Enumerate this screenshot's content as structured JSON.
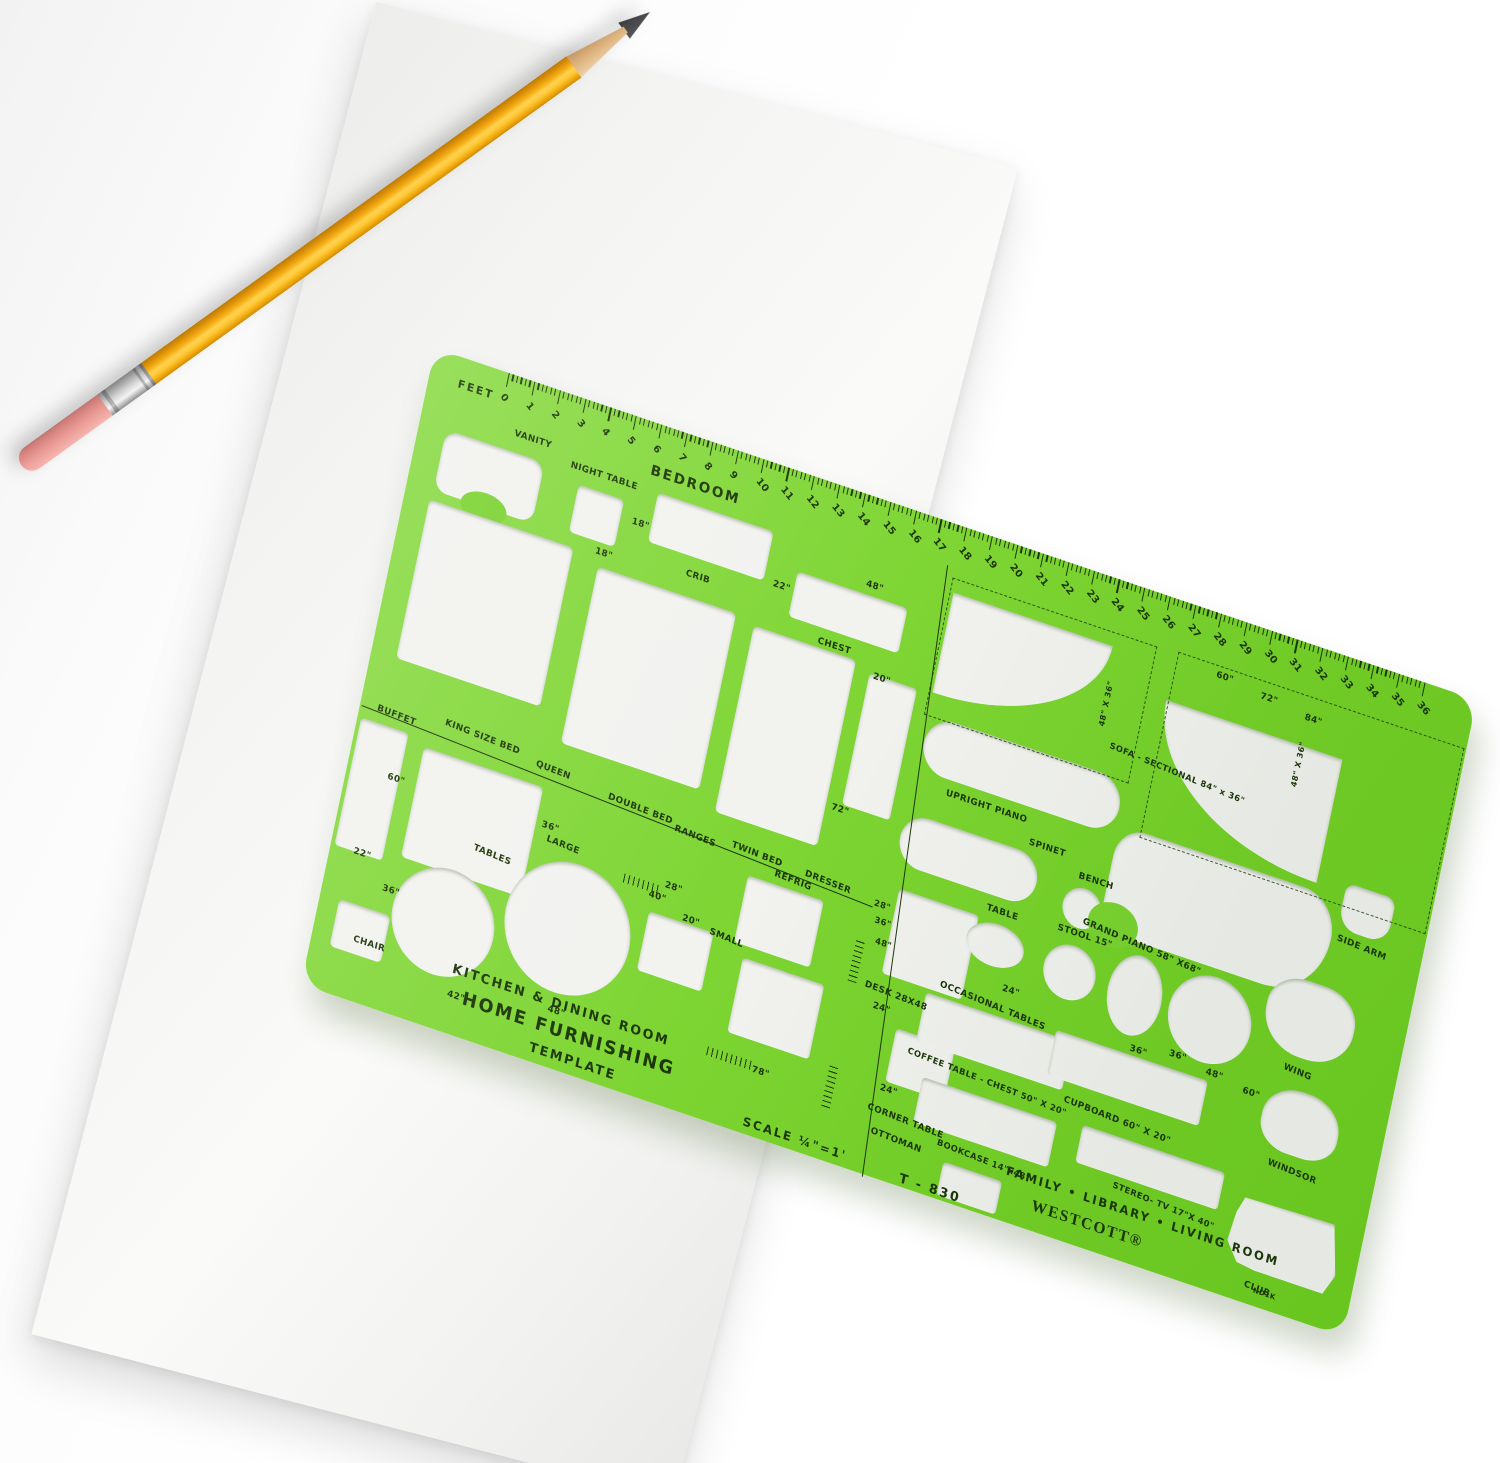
{
  "scene": {
    "background_color": "#ffffff",
    "paper": {
      "color": "#f4f4f2"
    },
    "pencil": {
      "body": "#f3a90e",
      "eraser": "#e8948f",
      "ferrule": "#cfcfcf",
      "wood": "#dfb684",
      "lead": "#454545"
    },
    "template": {
      "color": "#7bd331",
      "text_color": "#1c3608",
      "model": "T - 830",
      "scale": "SCALE ¼\"=1'",
      "brand": "WESTCOTT®",
      "part_code": "ND1K",
      "ruler": {
        "label": "FEET",
        "start": 0,
        "end": 36
      },
      "headings": {
        "bedroom": "BEDROOM",
        "kitchen": "KITCHEN & DINING ROOM",
        "product1": "HOME FURNISHING",
        "product2": "TEMPLATE",
        "family": "FAMILY • LIBRARY • LIVING ROOM"
      },
      "labels": [
        {
          "n": "bedroom-heading",
          "t": "BEDROOM",
          "x": 238,
          "y": 40,
          "fs": 14,
          "cls": "hd"
        },
        {
          "n": "vanity",
          "t": "VANITY",
          "x": 96,
          "y": 52,
          "fs": 9
        },
        {
          "n": "night-table",
          "t": "NIGHT TABLE",
          "x": 158,
          "y": 64,
          "fs": 9
        },
        {
          "n": "dim-18a",
          "t": "18\"",
          "x": 230,
          "y": 98,
          "fs": 9
        },
        {
          "n": "dim-18b",
          "t": "18\"",
          "x": 200,
          "y": 138,
          "fs": 9
        },
        {
          "n": "crib",
          "t": "CRIB",
          "x": 294,
          "y": 130,
          "fs": 9
        },
        {
          "n": "dim-22crib",
          "t": "22\"",
          "x": 382,
          "y": 112,
          "fs": 9
        },
        {
          "n": "dim-48chest",
          "t": "48\"",
          "x": 474,
          "y": 82,
          "fs": 9
        },
        {
          "n": "chest",
          "t": "CHEST",
          "x": 438,
          "y": 152,
          "fs": 9
        },
        {
          "n": "dim-20chest",
          "t": "20\"",
          "x": 500,
          "y": 168,
          "fs": 9
        },
        {
          "n": "dim-72",
          "t": "72\"",
          "x": 486,
          "y": 306,
          "fs": 9
        },
        {
          "n": "buffet",
          "t": "BUFFET",
          "x": 18,
          "y": 358,
          "fs": 9,
          "rot": 3
        },
        {
          "n": "king-size-bed",
          "t": "KING SIZE BED",
          "x": 88,
          "y": 350,
          "fs": 9,
          "rot": 3
        },
        {
          "n": "queen",
          "t": "QUEEN",
          "x": 186,
          "y": 360,
          "fs": 9,
          "rot": 3
        },
        {
          "n": "double-bed",
          "t": "DOUBLE BED",
          "x": 264,
          "y": 368,
          "fs": 9,
          "rot": 3
        },
        {
          "n": "ranges",
          "t": "RANGES",
          "x": 336,
          "y": 377,
          "fs": 9,
          "rot": 3
        },
        {
          "n": "twin-bed",
          "t": "TWIN BED",
          "x": 396,
          "y": 374,
          "fs": 9,
          "rot": 3
        },
        {
          "n": "refrig",
          "t": "REFRIG",
          "x": 444,
          "y": 388,
          "fs": 9,
          "rot": 3
        },
        {
          "n": "dresser",
          "t": "DRESSER",
          "x": 474,
          "y": 378,
          "fs": 9,
          "rot": 3
        },
        {
          "n": "dim-60queen",
          "t": "60\"",
          "x": 42,
          "y": 420,
          "fs": 9
        },
        {
          "n": "dim-36queen",
          "t": "36\"",
          "x": 204,
          "y": 416,
          "fs": 9
        },
        {
          "n": "dim-36tables",
          "t": "36\"",
          "x": 60,
          "y": 528,
          "fs": 9
        },
        {
          "n": "dim-22chair",
          "t": "22\"",
          "x": 24,
          "y": 502,
          "fs": 9
        },
        {
          "n": "chair",
          "t": "CHAIR",
          "x": 42,
          "y": 586,
          "fs": 9
        },
        {
          "n": "tables",
          "t": "TABLES",
          "x": 142,
          "y": 460,
          "fs": 9,
          "rot": 4
        },
        {
          "n": "large",
          "t": "LARGE",
          "x": 212,
          "y": 428,
          "fs": 9,
          "rot": 4
        },
        {
          "n": "dim-42",
          "t": "42\"",
          "x": 146,
          "y": 608,
          "fs": 9
        },
        {
          "n": "dim-48tables",
          "t": "48\"",
          "x": 248,
          "y": 590,
          "fs": 9
        },
        {
          "n": "dim-28range",
          "t": "28\"",
          "x": 338,
          "y": 434,
          "fs": 9
        },
        {
          "n": "dim-40",
          "t": "40\"",
          "x": 324,
          "y": 448,
          "fs": 9
        },
        {
          "n": "dim-20small",
          "t": "20\"",
          "x": 362,
          "y": 460,
          "fs": 9
        },
        {
          "n": "small",
          "t": "SMALL",
          "x": 392,
          "y": 464,
          "fs": 9,
          "rot": 4
        },
        {
          "n": "dim-78",
          "t": "78\"",
          "x": 462,
          "y": 582,
          "fs": 9
        },
        {
          "n": "dim-28div",
          "t": "28\"",
          "x": 548,
          "y": 384,
          "fs": 8.5
        },
        {
          "n": "dim-36div",
          "t": "36\"",
          "x": 552,
          "y": 400,
          "fs": 8.5
        },
        {
          "n": "dim-48div",
          "t": "48\"",
          "x": 557,
          "y": 420,
          "fs": 8.5
        },
        {
          "n": "kitchen-heading",
          "t": "KITCHEN & DINING ROOM",
          "x": 146,
          "y": 580,
          "fs": 13,
          "cls": "hd"
        },
        {
          "n": "home-furnishing",
          "t": "HOME FURNISHING",
          "x": 162,
          "y": 603,
          "fs": 18,
          "cls": "hd"
        },
        {
          "n": "template-word",
          "t": "TEMPLATE",
          "x": 238,
          "y": 630,
          "fs": 13,
          "cls": "hd"
        },
        {
          "n": "scale",
          "t": "SCALE ¼\"=1'",
          "x": 464,
          "y": 632,
          "fs": 12,
          "cls": "hd"
        },
        {
          "n": "model",
          "t": "T - 830",
          "x": 630,
          "y": 636,
          "fs": 13,
          "cls": "hd"
        },
        {
          "n": "family-heading",
          "t": "FAMILY • LIBRARY • LIVING ROOM",
          "x": 734,
          "y": 594,
          "fs": 12,
          "cls": "hd"
        },
        {
          "n": "brand",
          "t": "WESTCOTT®",
          "x": 766,
          "y": 618,
          "fs": 16,
          "cls": "brand"
        },
        {
          "n": "part-code",
          "t": "ND1K",
          "x": 1002,
          "y": 632,
          "fs": 7
        },
        {
          "n": "upright-piano",
          "t": "UPRIGHT PIANO",
          "x": 596,
          "y": 256,
          "fs": 9
        },
        {
          "n": "sofa-sectional",
          "t": "SOFA - SECTIONAL 84\" x 36\"",
          "x": 748,
          "y": 158,
          "fs": 8.5,
          "rot": 4
        },
        {
          "n": "dim-48x36-a",
          "t": "48\" X 36\"",
          "x": 732,
          "y": 100,
          "fs": 8,
          "vert": 1
        },
        {
          "n": "dim-48x36-b",
          "t": "48\" X 36\"",
          "x": 934,
          "y": 96,
          "fs": 8,
          "vert": 1
        },
        {
          "n": "dim-60sofa",
          "t": "60\"",
          "x": 838,
          "y": 56,
          "fs": 9
        },
        {
          "n": "dim-72sofa",
          "t": "72\"",
          "x": 886,
          "y": 62,
          "fs": 9
        },
        {
          "n": "dim-84sofa",
          "t": "84\"",
          "x": 934,
          "y": 68,
          "fs": 9
        },
        {
          "n": "spinet",
          "t": "SPINET",
          "x": 688,
          "y": 276,
          "fs": 9
        },
        {
          "n": "bench",
          "t": "BENCH",
          "x": 744,
          "y": 292,
          "fs": 9
        },
        {
          "n": "table",
          "t": "TABLE",
          "x": 660,
          "y": 352,
          "fs": 9
        },
        {
          "n": "stool",
          "t": "STOOL 15\"",
          "x": 734,
          "y": 348,
          "fs": 9
        },
        {
          "n": "dim-24occ",
          "t": "24\"",
          "x": 692,
          "y": 424,
          "fs": 9
        },
        {
          "n": "occasional-tables",
          "t": "OCCASIONAL TABLES",
          "x": 630,
          "y": 440,
          "fs": 9,
          "rot": 4
        },
        {
          "n": "grand-piano",
          "t": "GRAND PIANO 58\" X68\"",
          "x": 758,
          "y": 334,
          "fs": 9,
          "rot": 5
        },
        {
          "n": "dim-36grand",
          "t": "36\"",
          "x": 830,
          "y": 440,
          "fs": 9
        },
        {
          "n": "side-arm",
          "t": "SIDE ARM",
          "x": 1012,
          "y": 268,
          "fs": 9,
          "rot": 4
        },
        {
          "n": "wing",
          "t": "WING",
          "x": 986,
          "y": 408,
          "fs": 9,
          "rot": 4
        },
        {
          "n": "windsor",
          "t": "WINDSOR",
          "x": 990,
          "y": 504,
          "fs": 9,
          "rot": 4
        },
        {
          "n": "club",
          "t": "CLUB",
          "x": 992,
          "y": 628,
          "fs": 9,
          "rot": 4
        },
        {
          "n": "dim-36cup",
          "t": "36\"",
          "x": 870,
          "y": 432,
          "fs": 9
        },
        {
          "n": "dim-48cup",
          "t": "48\"",
          "x": 910,
          "y": 438,
          "fs": 9
        },
        {
          "n": "dim-60cup",
          "t": "60\"",
          "x": 950,
          "y": 444,
          "fs": 9
        },
        {
          "n": "cupboard",
          "t": "CUPBOARD  60\"  X 20\"",
          "x": 776,
          "y": 510,
          "fs": 9,
          "rot": 3
        },
        {
          "n": "stereo-tv",
          "t": "STEREO- TV  17\"X 40\"",
          "x": 842,
          "y": 576,
          "fs": 8.5,
          "rot": 4
        },
        {
          "n": "coffee-table",
          "t": "COFFEE TABLE - CHEST  50\"  X 20\"",
          "x": 612,
          "y": 514,
          "fs": 8.5,
          "rot": 3
        },
        {
          "n": "bookcase",
          "t": "BOOKCASE 14\"x48\"",
          "x": 660,
          "y": 592,
          "fs": 8.5,
          "rot": 3
        },
        {
          "n": "desk",
          "t": "DESK  28X48",
          "x": 556,
          "y": 464,
          "fs": 9,
          "rot": 3
        },
        {
          "n": "dim-24desk",
          "t": "24\"",
          "x": 568,
          "y": 482,
          "fs": 9
        },
        {
          "n": "dim-24corner",
          "t": "24\"",
          "x": 592,
          "y": 558,
          "fs": 9
        },
        {
          "n": "corner-table",
          "t": "CORNER TABLE",
          "x": 584,
          "y": 580,
          "fs": 9,
          "rot": 3
        },
        {
          "n": "ottoman",
          "t": "OTTOMAN",
          "x": 592,
          "y": 602,
          "fs": 9,
          "rot": 3
        }
      ],
      "cutouts": [
        {
          "n": "vanity",
          "x": 28,
          "y": 74,
          "w": 104,
          "h": 62,
          "br": "14px",
          "cls": "notch-b"
        },
        {
          "n": "night-table",
          "x": 170,
          "y": 84,
          "w": 48,
          "h": 48,
          "br": "5px"
        },
        {
          "n": "crib",
          "x": 250,
          "y": 66,
          "w": 122,
          "h": 50,
          "br": "5px"
        },
        {
          "n": "chest",
          "x": 404,
          "y": 96,
          "w": 116,
          "h": 46,
          "br": "5px"
        },
        {
          "n": "king-bed",
          "x": 26,
          "y": 146,
          "w": 152,
          "h": 162,
          "br": "5px"
        },
        {
          "n": "double-bed",
          "x": 206,
          "y": 156,
          "w": 146,
          "h": 180,
          "br": "5px"
        },
        {
          "n": "twin-bed",
          "x": 372,
          "y": 162,
          "w": 108,
          "h": 190,
          "br": "5px"
        },
        {
          "n": "dresser-tall",
          "x": 496,
          "y": 170,
          "w": 50,
          "h": 134,
          "br": "4px"
        },
        {
          "n": "buffet",
          "x": 4,
          "y": 376,
          "w": 50,
          "h": 130,
          "br": "4px"
        },
        {
          "n": "queen-bed",
          "x": 72,
          "y": 384,
          "w": 126,
          "h": 112,
          "br": "5px"
        },
        {
          "n": "chair",
          "x": 20,
          "y": 556,
          "w": 54,
          "h": 48,
          "br": "5px"
        },
        {
          "n": "table-42",
          "x": 74,
          "y": 492,
          "w": 106,
          "h": 106,
          "br": "50%"
        },
        {
          "n": "table-48",
          "x": 186,
          "y": 446,
          "w": 130,
          "h": 130,
          "br": "50%"
        },
        {
          "n": "range-small",
          "x": 328,
          "y": 468,
          "w": 68,
          "h": 60,
          "br": "4px"
        },
        {
          "n": "refrigerator",
          "x": 418,
          "y": 402,
          "w": 80,
          "h": 68,
          "br": "4px"
        },
        {
          "n": "dresser-low",
          "x": 430,
          "y": 482,
          "w": 86,
          "h": 76,
          "br": "4px"
        },
        {
          "n": "desk",
          "x": 570,
          "y": 366,
          "w": 84,
          "h": 86,
          "br": "4px"
        },
        {
          "n": "corner-table",
          "x": 596,
          "y": 500,
          "w": 62,
          "h": 54,
          "br": "4px"
        },
        {
          "n": "ottoman",
          "x": 670,
          "y": 612,
          "w": 62,
          "h": 34,
          "br": "4px"
        },
        {
          "n": "coffee-chest",
          "x": 618,
          "y": 456,
          "w": 154,
          "h": 50,
          "br": "4px"
        },
        {
          "n": "bookcase",
          "x": 632,
          "y": 538,
          "w": 142,
          "h": 46,
          "br": "4px"
        },
        {
          "n": "sectional-corner-left",
          "x": 562,
          "y": 66,
          "w": 168,
          "h": 102,
          "cls": "q-br"
        },
        {
          "n": "sectional-corner-right",
          "x": 794,
          "y": 100,
          "w": 186,
          "h": 126,
          "cls": "q-bl"
        },
        {
          "n": "upright-piano",
          "x": 564,
          "y": 190,
          "w": 206,
          "h": 56,
          "br": "28px"
        },
        {
          "n": "spinet",
          "x": 560,
          "y": 290,
          "w": 144,
          "h": 52,
          "br": "26px"
        },
        {
          "n": "bench",
          "x": 734,
          "y": 306,
          "w": 40,
          "h": 40,
          "br": "50%"
        },
        {
          "n": "occ-table-oval",
          "x": 646,
          "y": 368,
          "w": 60,
          "h": 42,
          "br": "50%"
        },
        {
          "n": "stool-15",
          "x": 728,
          "y": 364,
          "w": 54,
          "h": 54,
          "br": "50%"
        },
        {
          "n": "grand-piano",
          "x": 774,
          "y": 234,
          "w": 232,
          "h": 106,
          "br": "30px 40px 64px 26px / 34px 44px 70px 30px",
          "cls": "notch-bl"
        },
        {
          "n": "occ-ellipse",
          "x": 796,
          "y": 352,
          "w": 56,
          "h": 80,
          "br": "50%"
        },
        {
          "n": "occ-circle",
          "x": 860,
          "y": 348,
          "w": 86,
          "h": 86,
          "br": "50%"
        },
        {
          "n": "side-arm",
          "x": 1010,
          "y": 216,
          "w": 52,
          "h": 46,
          "br": "10px 10px 20px 20px"
        },
        {
          "n": "wing-chair",
          "x": 956,
          "y": 322,
          "w": 92,
          "h": 76,
          "br": "40% 40% 46% 46% / 42% 42% 52% 52%"
        },
        {
          "n": "windsor-chair",
          "x": 974,
          "y": 430,
          "w": 80,
          "h": 64,
          "br": "46% 46% 40% 40% / 50% 50% 42% 42%"
        },
        {
          "n": "club-chair",
          "x": 966,
          "y": 546,
          "w": 114,
          "h": 70,
          "cls": "club"
        },
        {
          "n": "cupboard",
          "x": 754,
          "y": 450,
          "w": 160,
          "h": 46,
          "br": "4px"
        },
        {
          "n": "stereo-tv",
          "x": 800,
          "y": 532,
          "w": 150,
          "h": 38,
          "br": "4px"
        }
      ],
      "lines": [
        {
          "n": "divider-beds",
          "x": 2,
          "y": 364,
          "len": 546,
          "rot": 2.9
        },
        {
          "n": "divider-sections",
          "x": 550,
          "y": 42,
          "len": 612,
          "rot": -4,
          "vert": 1
        }
      ],
      "dashed_boxes": [
        {
          "n": "sofa-dash-left",
          "x": 558,
          "y": 52,
          "w": 214,
          "h": 138
        },
        {
          "n": "sofa-dash-right",
          "x": 796,
          "y": 50,
          "w": 300,
          "h": 188
        }
      ],
      "tick_clusters": [
        {
          "n": "ticks-range",
          "x": 296,
          "y": 440,
          "w": 40,
          "h": 9
        },
        {
          "n": "ticks-78",
          "x": 414,
          "y": 578,
          "w": 46,
          "h": 9
        },
        {
          "n": "ticks-div-upper",
          "x": 538,
          "y": 428,
          "w": 9,
          "h": 42,
          "vert": 1
        },
        {
          "n": "ticks-div-lower",
          "x": 538,
          "y": 556,
          "w": 9,
          "h": 42,
          "vert": 1
        }
      ]
    }
  }
}
